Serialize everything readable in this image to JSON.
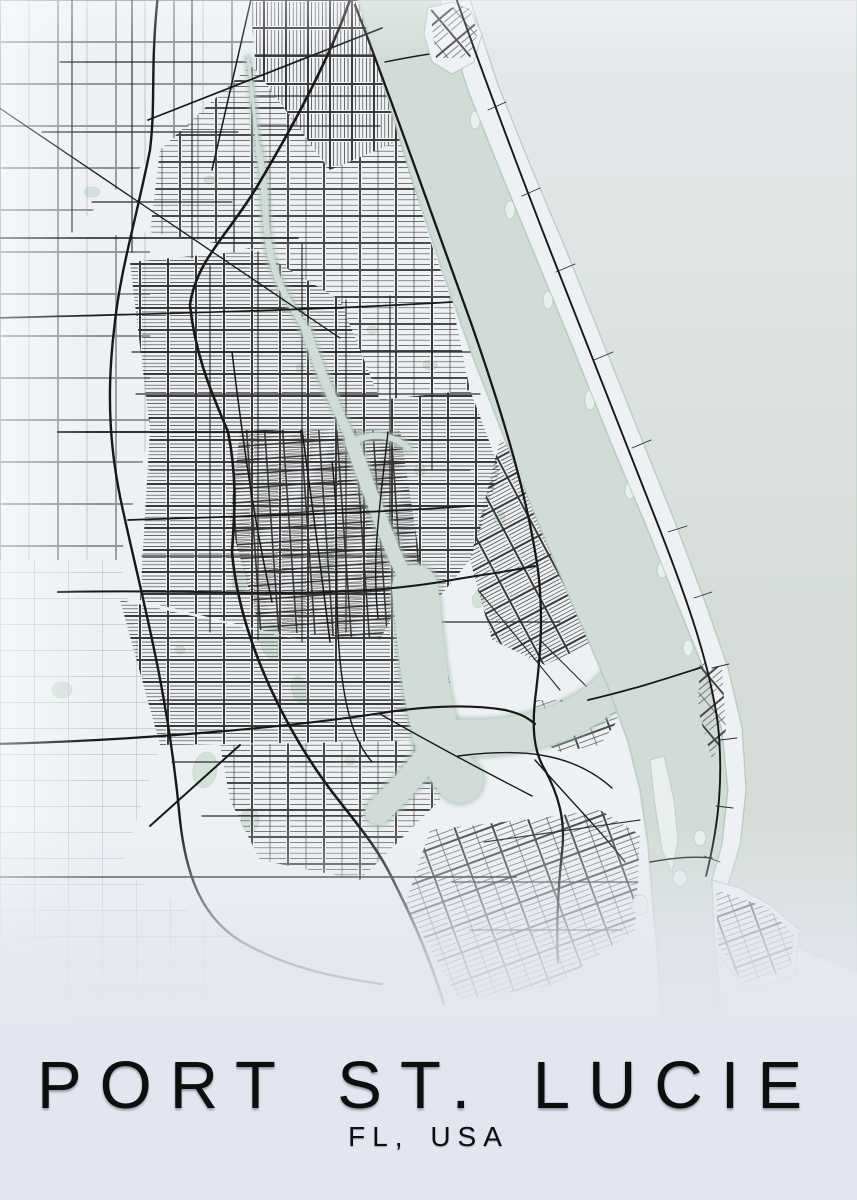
{
  "poster": {
    "title": "PORT ST. LUCIE",
    "subtitle": "FL, USA"
  },
  "palette": {
    "bg": "#e3e6f0",
    "land": "#eef1f4",
    "water": "#d2dcd6",
    "oceanTop": "#e6e9ed",
    "oceanBottom": "#d6ddd8",
    "shore": "#a8c3b5",
    "marsh": "#cfe0d5",
    "islet": "#e9efec",
    "roadMajor": "#181818",
    "roadMid": "#2b2b2b",
    "roadMinor": "#3a3a3a",
    "roadFine": "#2f2f2f",
    "roadMed": "#4a4a4a",
    "roadRural": "#8e979c",
    "roadFaint": "#b7c0c6",
    "ink": "#0e0e0e"
  }
}
